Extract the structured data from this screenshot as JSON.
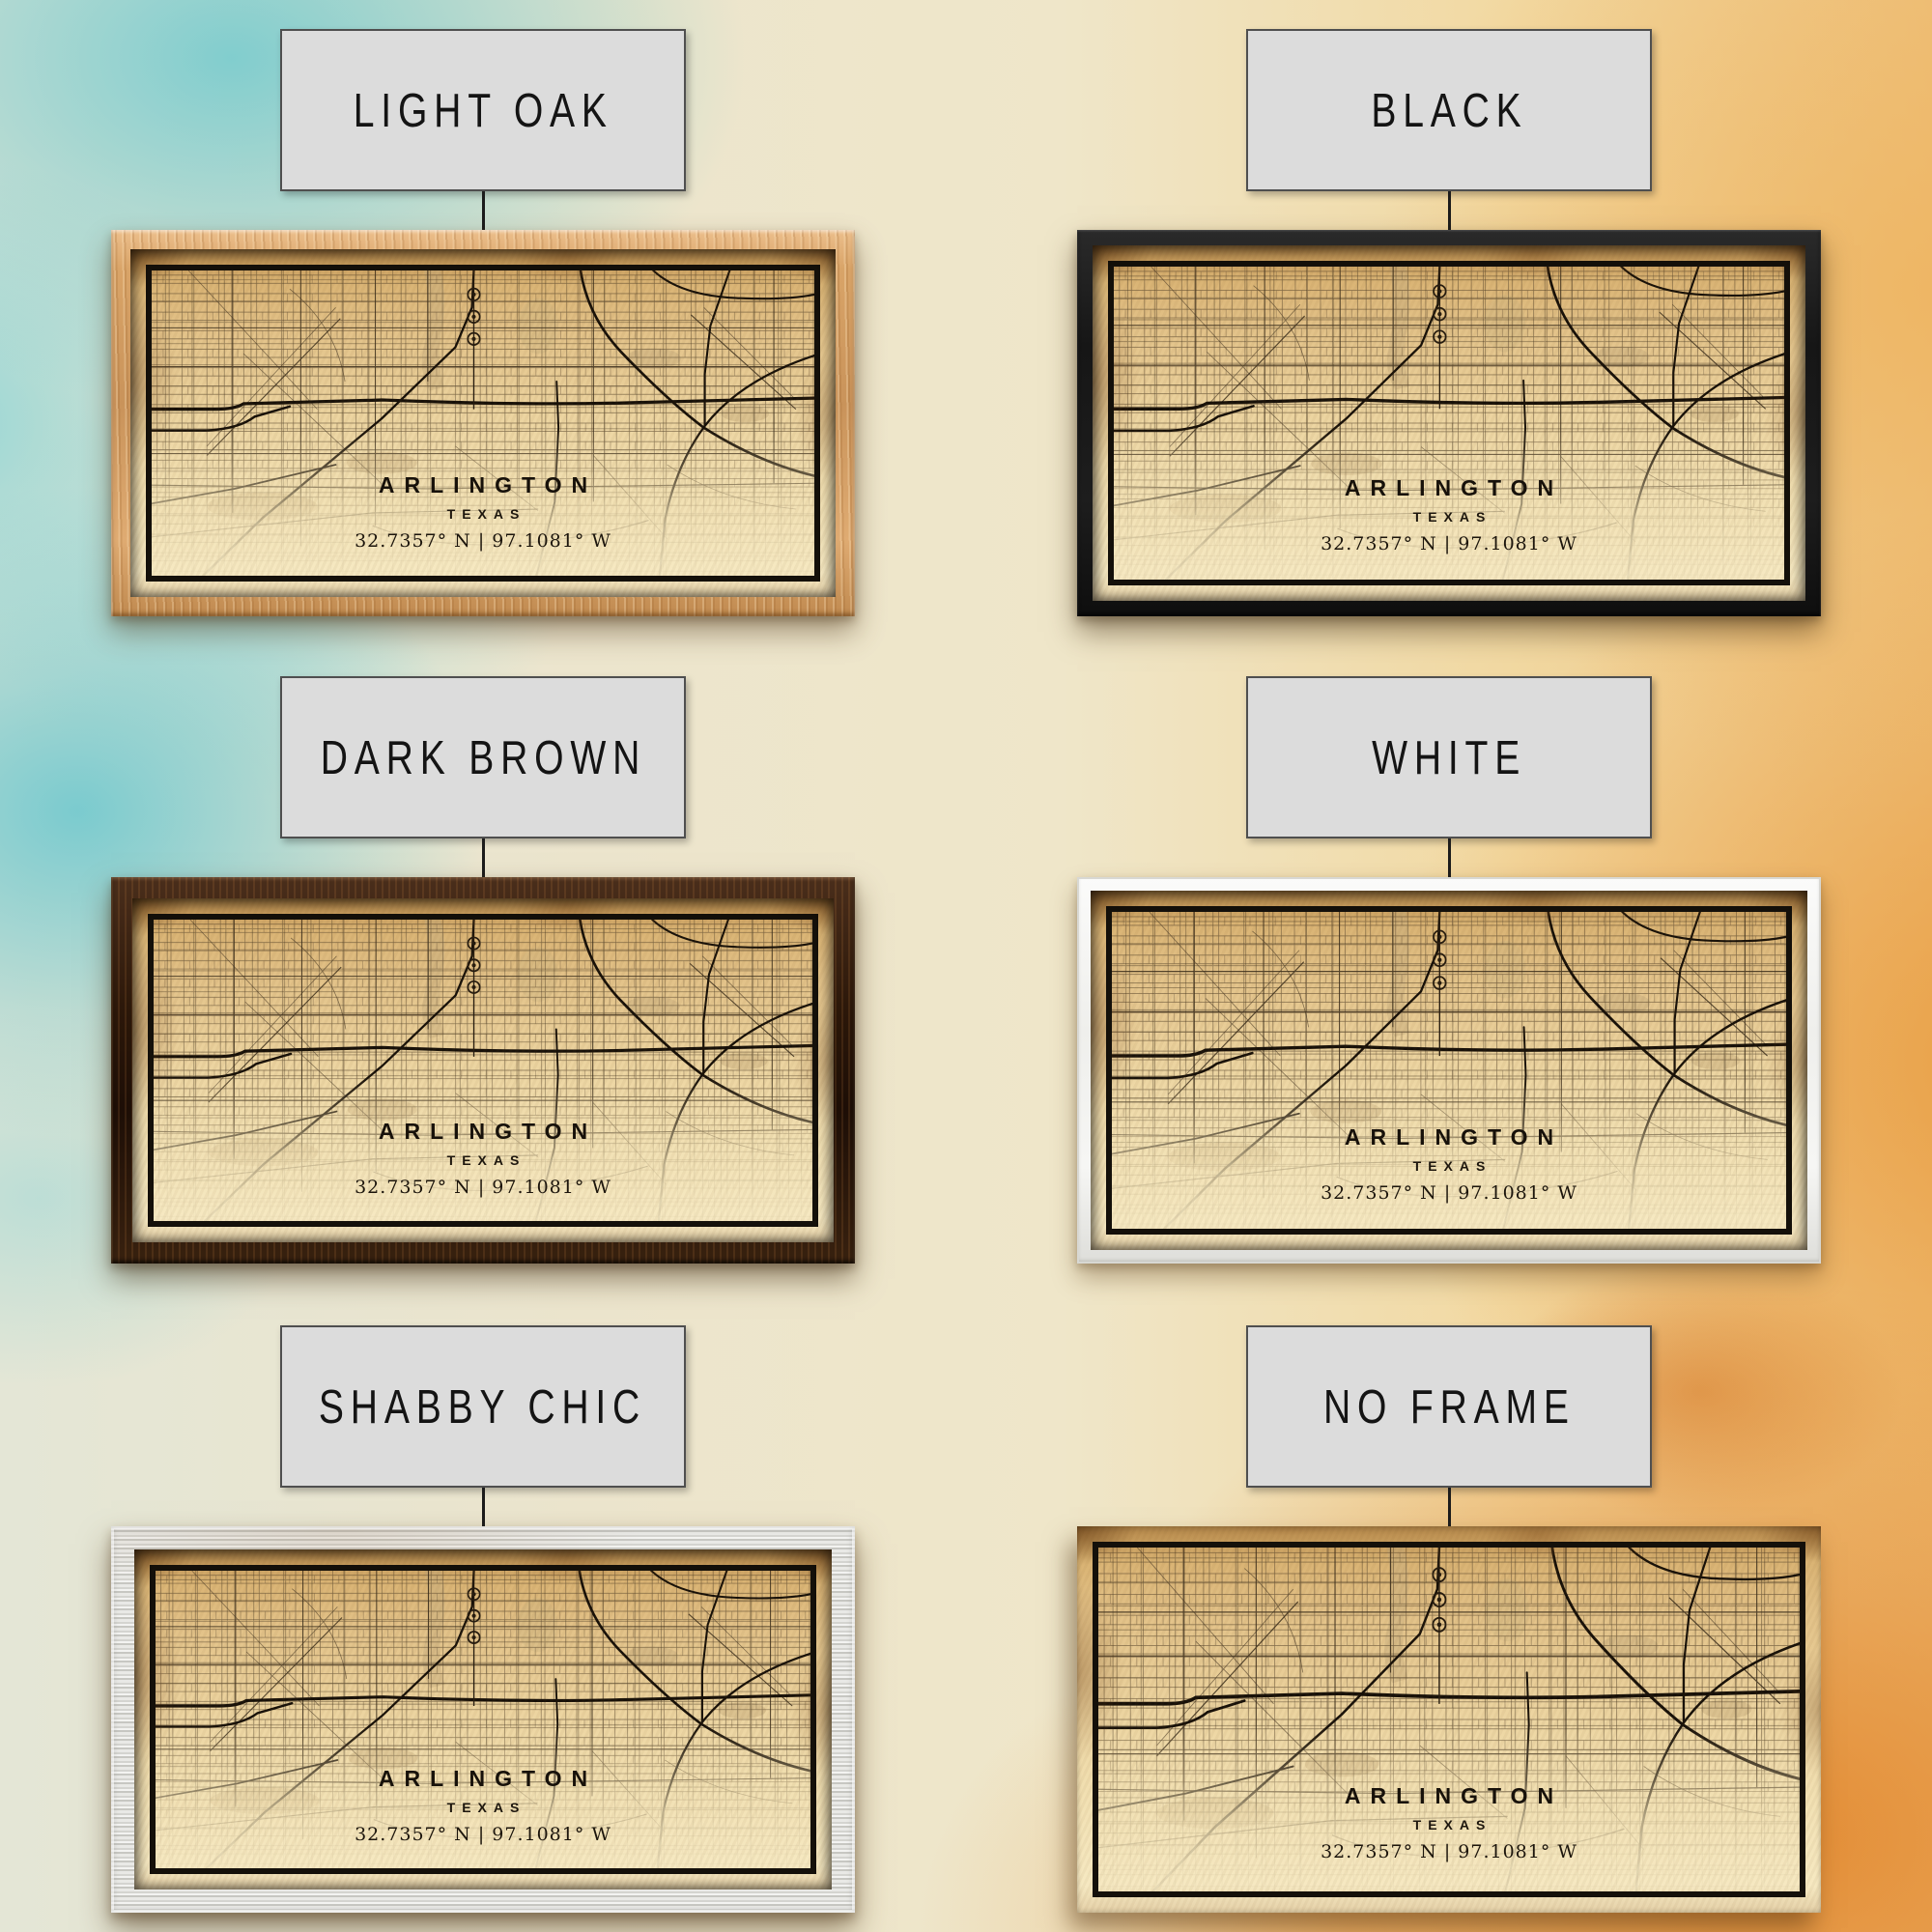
{
  "artwork": {
    "city": "ARLINGTON",
    "state": "TEXAS",
    "coordinates": "32.7357° N | 97.1081° W"
  },
  "variants": [
    {
      "id": "light-oak",
      "label": "LIGHT OAK"
    },
    {
      "id": "black",
      "label": "BLACK"
    },
    {
      "id": "dark-brown",
      "label": "DARK BROWN"
    },
    {
      "id": "white",
      "label": "WHITE"
    },
    {
      "id": "shabby-chic",
      "label": "SHABBY CHIC"
    },
    {
      "id": "no-frame",
      "label": "NO FRAME"
    }
  ],
  "colors": {
    "label_bg": "#dcdcdc",
    "label_border": "#4f4f4f",
    "paper": "#ecd4a0",
    "map_ink": "#171008",
    "teal_wash": "#6ec7cd",
    "orange_wash": "#e99b3e",
    "light_oak": "#d9a468",
    "black_frame": "#1a1a1a",
    "dark_brown": "#2b1709",
    "white_frame": "#f4f4f2",
    "shabby_chic": "#dcdcd8"
  }
}
